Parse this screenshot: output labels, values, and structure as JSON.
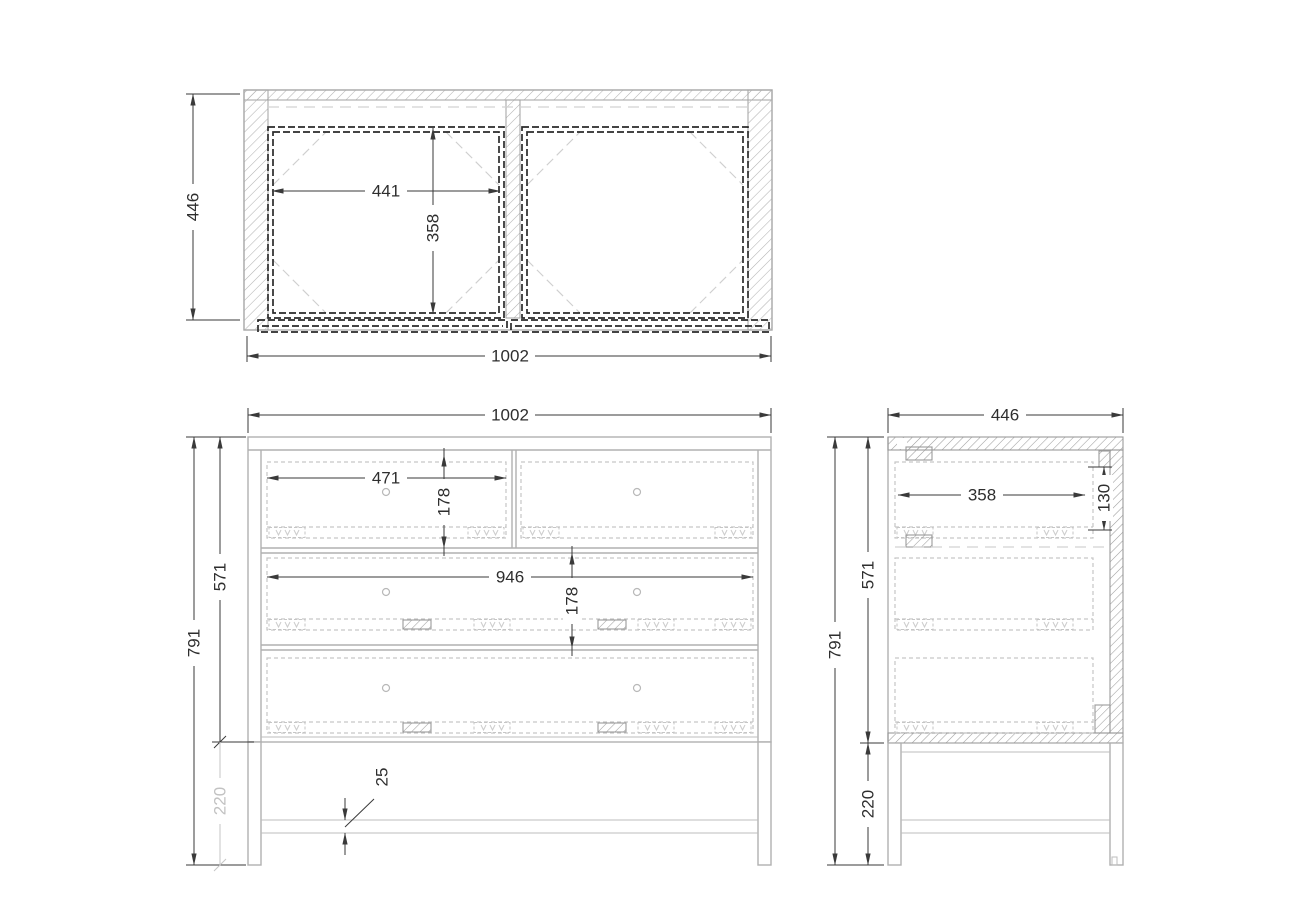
{
  "drawing": {
    "type": "furniture-orthographic-drawing",
    "subject": "chest-of-drawers",
    "views": {
      "top": "top-view",
      "front": "front-view",
      "side": "side-view"
    }
  },
  "dims": {
    "top": {
      "height": "446",
      "drawer_width": "441",
      "drawer_depth": "358",
      "width": "1002"
    },
    "front": {
      "width": "1002",
      "top_drawer_width": "471",
      "top_drawer_height": "178",
      "wide_drawer_width": "946",
      "wide_drawer_height": "178",
      "overall_height": "791",
      "carcass_height": "571",
      "base_height": "220",
      "rail_thickness": "25"
    },
    "side": {
      "depth": "446",
      "drawer_depth": "358",
      "drawer_back_height": "130",
      "carcass_height": "571",
      "overall_height": "791",
      "base_height": "220"
    }
  },
  "colors": {
    "geometry_gray": "#b0b0b0",
    "dashed_hidden_gray": "#c6c6c6",
    "drawer_hidden_black": "#2a2a2a",
    "dimension_dark": "#3a3a3a",
    "dimension_gray": "#c2c2c2",
    "background": "#ffffff"
  }
}
